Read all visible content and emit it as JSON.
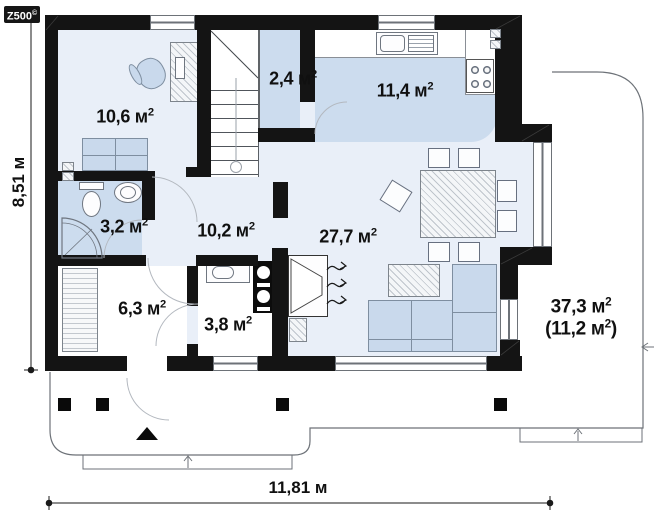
{
  "logo": {
    "brand": "Z500",
    "mark": "©"
  },
  "plan": {
    "rooms": [
      {
        "key": "cabinet",
        "area": "10,6",
        "unit": " м",
        "exp": "2"
      },
      {
        "key": "pantry",
        "area": "2,4",
        "unit": " м",
        "exp": "2"
      },
      {
        "key": "kitchen",
        "area": "11,4",
        "unit": " м",
        "exp": "2"
      },
      {
        "key": "bathroom",
        "area": "3,2",
        "unit": " м",
        "exp": "2"
      },
      {
        "key": "hall",
        "area": "10,2",
        "unit": " м",
        "exp": "2"
      },
      {
        "key": "living",
        "area": "27,7",
        "unit": " м",
        "exp": "2"
      },
      {
        "key": "entry",
        "area": "6,3",
        "unit": " м",
        "exp": "2"
      },
      {
        "key": "boiler",
        "area": "3,8",
        "unit": " м",
        "exp": "2"
      }
    ],
    "terrace": {
      "area": "37,3",
      "unit": " м",
      "exp": "2",
      "open": "(",
      "area2": "11,2",
      "unit2": " м",
      "exp2": "2",
      "close": ")"
    }
  },
  "dimensions": {
    "width": "11,81 м",
    "height": "8,51 м"
  },
  "colors": {
    "wall": "#141414",
    "accent_fill": "#ccdcee",
    "base_fill": "#e9eff8",
    "furniture_fill": "#c9d9ec"
  }
}
